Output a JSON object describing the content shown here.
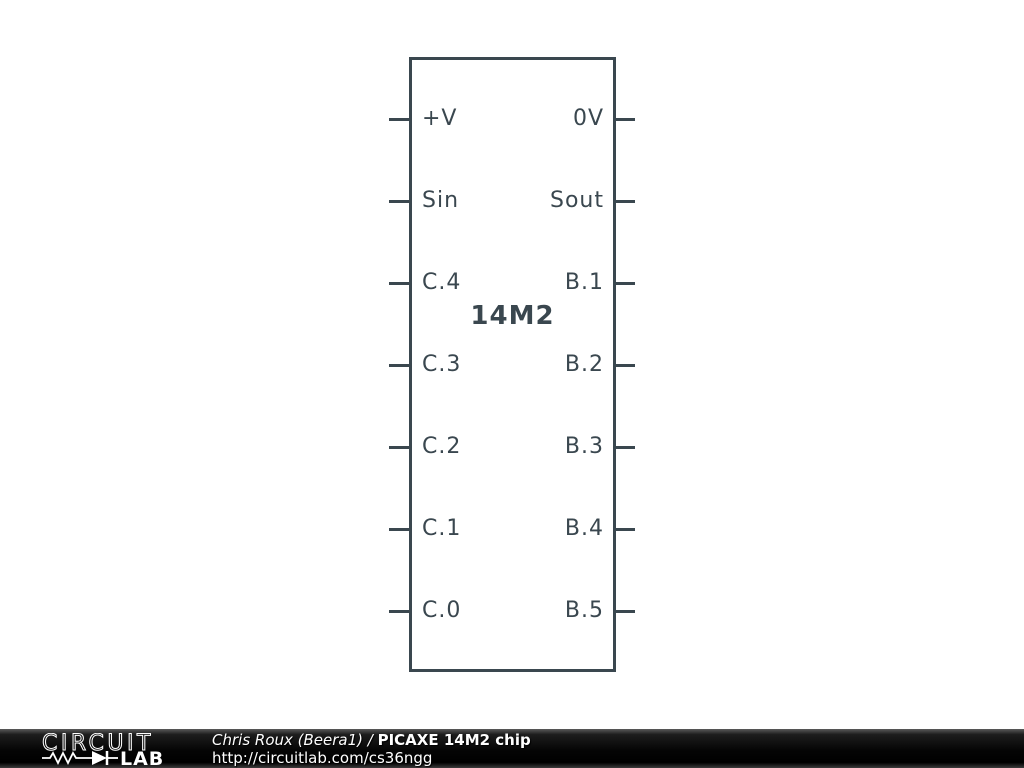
{
  "chip": {
    "name": "14M2",
    "left_pins": [
      "+V",
      "Sin",
      "C.4",
      "C.3",
      "C.2",
      "C.1",
      "C.0"
    ],
    "right_pins": [
      "0V",
      "Sout",
      "B.1",
      "B.2",
      "B.3",
      "B.4",
      "B.5"
    ]
  },
  "footer": {
    "logo_word_top": "CIRCUIT",
    "logo_word_bottom": "LAB",
    "author_prefix": "Chris Roux (Beera1) / ",
    "title": "PICAXE 14M2 chip",
    "url": "http://circuitlab.com/cs36ngg"
  },
  "colors": {
    "schematic_stroke": "#3a474f",
    "footer_background": "#000000",
    "footer_text": "#ffffff"
  }
}
